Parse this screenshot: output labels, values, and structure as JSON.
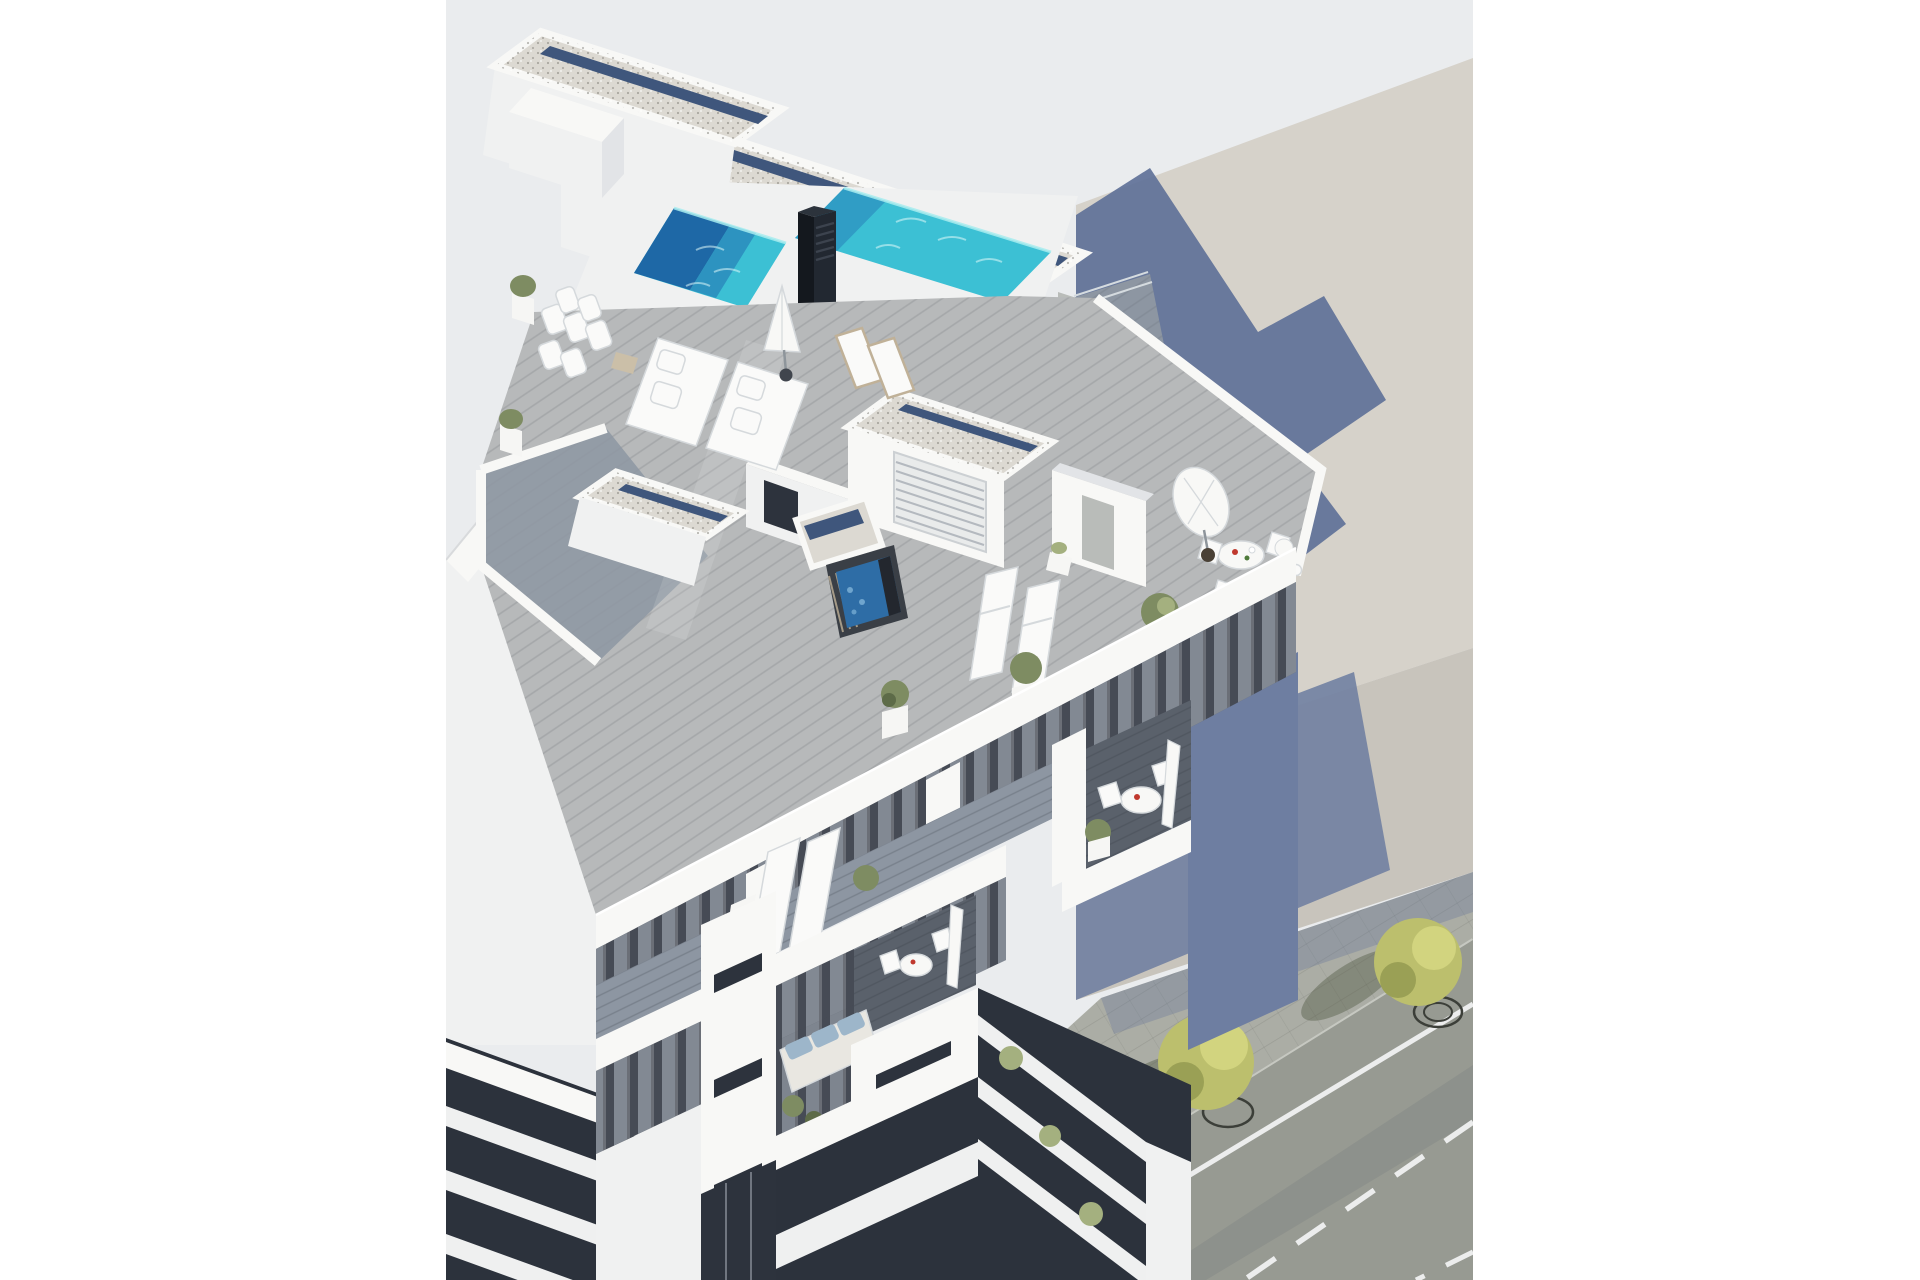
{
  "meta": {
    "type": "3d-architectural-render",
    "view": "high-angle aerial view",
    "description": "New-build white apartment building seen from above, with a rooftop swimming pool, gravel roofs, wooden roof terraces with loungers and a jacuzzi, balconies with outdoor furniture, adjacent buildings and a street corner with trees and road markings"
  },
  "canvas": {
    "width": 1920,
    "height": 1280,
    "photo_left": 446,
    "photo_top": 0,
    "photo_width": 1027,
    "photo_height": 1280
  },
  "colors": {
    "margin": "#ffffff",
    "backdrop": "#eaecee",
    "beige-roof": "#d6d2ca",
    "beige-wall": "#c8c4bc",
    "shadow-blue": "#5f7198",
    "shadow-wall": "#6e7ea1",
    "white-top": "#f8f8f6",
    "white-face": "#f0f1f1",
    "white-shade": "#e2e4e7",
    "gravel": "#dcd9d2",
    "gravel-blue": "#3f567c",
    "pool": "#3cc0d4",
    "pool-mid": "#2d93c0",
    "pool-deep": "#1e68a6",
    "pool-glow": "#a8ecef",
    "chimney-a": "#14181e",
    "chimney-b": "#222831",
    "chimney-c": "#2c333c",
    "deck": "#b7b9ba",
    "deck-shade": "#8d96a2",
    "deck-dark": "#5a616b",
    "facade": "#464b55",
    "glass": "#2d333d",
    "curtain": "#99a1ab",
    "slab": "#eff0f0",
    "cushion": "#fafaf9",
    "cushion-edge": "#d5d9dc",
    "sofa-blue": "#9db6ca",
    "sofa-frame": "#e9e7e1",
    "wood": "#c0b198",
    "plant": "#7e8c62",
    "plant-light": "#a4b07f",
    "plant-dark": "#5d6b48",
    "pot": "#f6f6f4",
    "tree": "#bcbf6d",
    "tree-light": "#d2d47f",
    "tree-dark": "#9aa055",
    "street": "#979a92",
    "sidewalk": "#abada5",
    "line": "#eceded",
    "pit": "#3c3f39",
    "red": "#c0392e",
    "green-acc": "#4e7a3a",
    "door": "#b9bcb9",
    "rail": "#d5dbdf",
    "base-dark": "#2c323c"
  },
  "scene": {
    "labels": {
      "root": "architectural render photo",
      "backdrop": "light gray render backdrop",
      "neighbor-right": "adjacent building roof with cast building shadow",
      "neighbor-left": "adjacent white buildings",
      "street": "street corner with sidewalk, road markings and trees",
      "building": "main apartment building",
      "roofs": "gravel flat roofs with parapets",
      "pool": "rooftop swimming pool",
      "chimney": "black louvered chimney",
      "terrace": "roof terrace with wooden decking",
      "jacuzzi": "hot tub",
      "daybeds": "white day beds and cushions",
      "loungers": "sun loungers",
      "umbrella": "white parasol",
      "dining": "outdoor dining set with parasol and bar table",
      "facade": "street facade with glass doors and curtains",
      "balcony-table": "balcony with round bistro table",
      "balcony-sofa": "balcony with blue cushioned sofa",
      "slabs": "stacked white balcony slabs",
      "entrance": "street level entrance",
      "trees": "yellow-green street trees"
    },
    "objects": [
      "rooftop pool",
      "jacuzzi",
      "sun loungers",
      "day beds",
      "parasols",
      "outdoor dining table",
      "bar table with stools",
      "potted plants and olive trees",
      "balcony sofa with blue cushions",
      "round bistro tables",
      "street trees",
      "dashed road markings",
      "paved sidewalk"
    ]
  }
}
